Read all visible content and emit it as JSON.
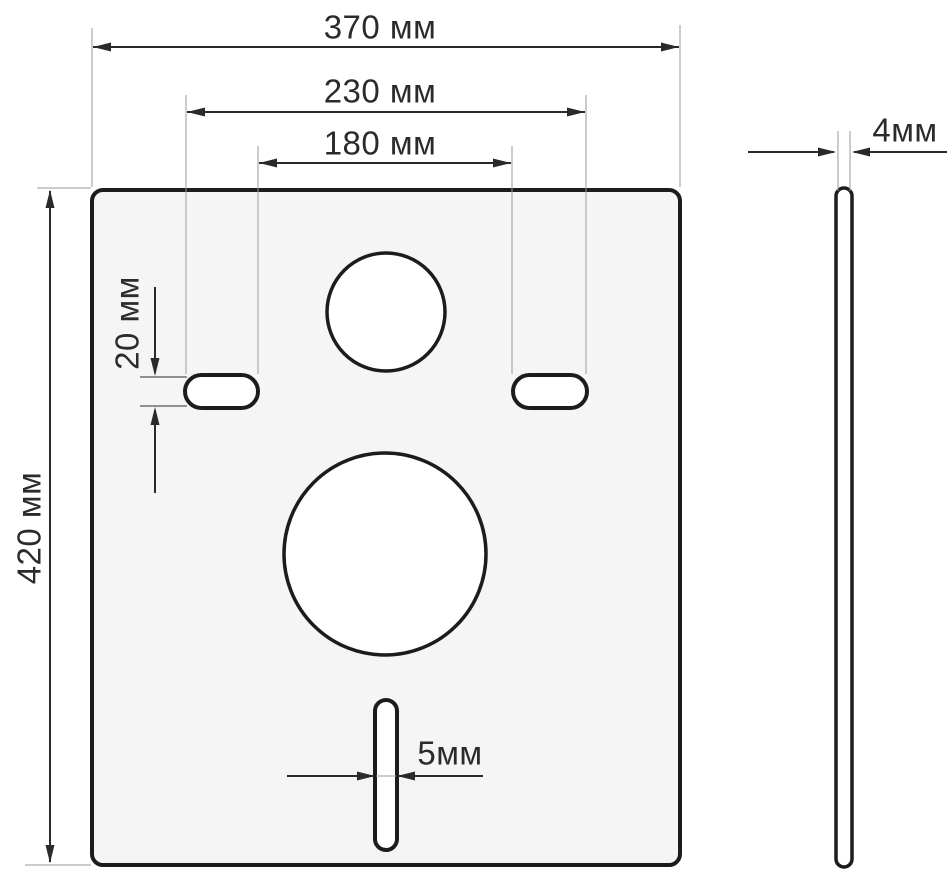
{
  "units": "мм",
  "labels": {
    "width": "370 мм",
    "holes_outer": "230 мм",
    "holes_inner": "180 мм",
    "height": "420 мм",
    "oval_height": "20 мм",
    "slot_width": "5мм",
    "thickness": "4мм"
  },
  "dimensions_mm": {
    "plate_width": 370,
    "plate_height": 420,
    "oval_holes_outer_span": 230,
    "oval_holes_inner_span": 180,
    "oval_hole_height": 20,
    "bottom_slot_width": 5,
    "plate_thickness": 4
  },
  "colors": {
    "background": "#ffffff",
    "plate_fill": "#f5f5f5",
    "hole_fill": "#ffffff",
    "outline": "#1c1c1c",
    "dimension_line": "#2a2a2a",
    "extension_line": "#9a9a9a"
  }
}
